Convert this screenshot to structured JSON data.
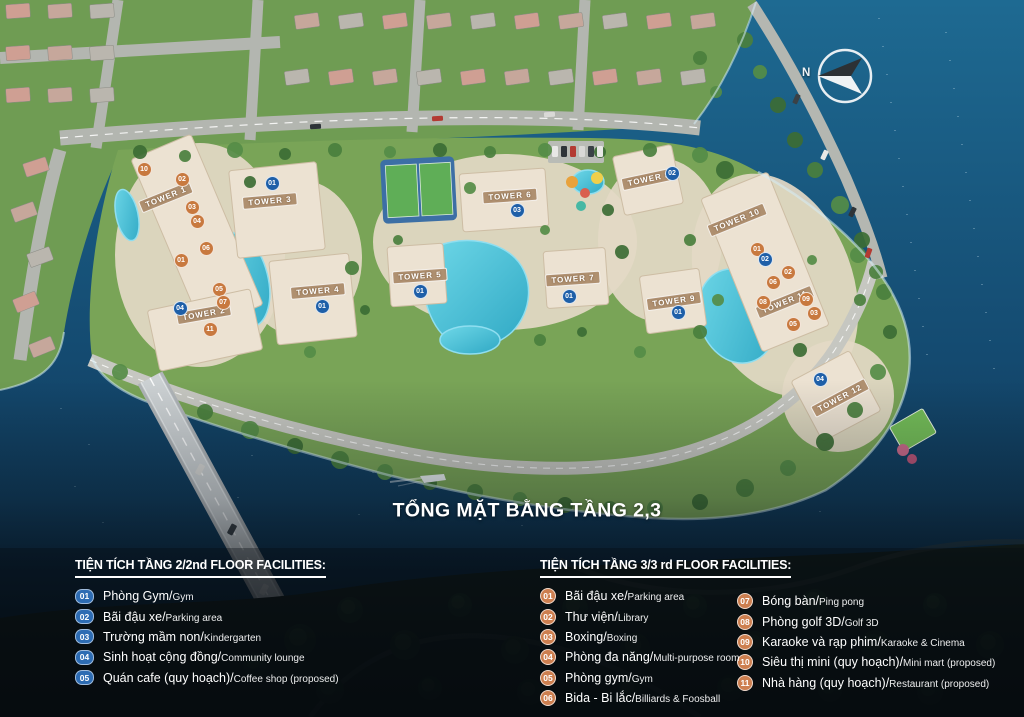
{
  "title": "TỔNG MẶT BẰNG TẦNG 2,3",
  "compass": {
    "label": "N"
  },
  "colors": {
    "badge_blue": "#2d6cb3",
    "badge_orange": "#cd7f50",
    "water": "#155a82",
    "site_ground": "#e7ddcc"
  },
  "legend_floor2": {
    "header": "TIỆN TÍCH TẦNG 2/2nd FLOOR FACILITIES:",
    "items": [
      {
        "num": "01",
        "vn": "Phòng Gym/",
        "en": "Gym"
      },
      {
        "num": "02",
        "vn": "Bãi đậu xe/",
        "en": "Parking area"
      },
      {
        "num": "03",
        "vn": "Trường mầm non/",
        "en": "Kindergarten"
      },
      {
        "num": "04",
        "vn": "Sinh hoạt cộng đồng/",
        "en": "Community lounge"
      },
      {
        "num": "05",
        "vn": "Quán cafe (quy hoạch)/",
        "en": "Coffee shop (proposed)"
      }
    ]
  },
  "legend_floor3": {
    "header": "TIỆN TÍCH TẦNG 3/3 rd FLOOR FACILITIES:",
    "items_col1": [
      {
        "num": "01",
        "vn": "Bãi đậu xe/",
        "en": "Parking area"
      },
      {
        "num": "02",
        "vn": "Thư viện/",
        "en": "Library"
      },
      {
        "num": "03",
        "vn": "Boxing/",
        "en": "Boxing"
      },
      {
        "num": "04",
        "vn": "Phòng đa năng/",
        "en": "Multi-purpose room"
      },
      {
        "num": "05",
        "vn": "Phòng gym/",
        "en": "Gym"
      },
      {
        "num": "06",
        "vn": "Bida - Bi lắc/",
        "en": "Billiards & Foosball"
      }
    ],
    "items_col2": [
      {
        "num": "07",
        "vn": "Bóng bàn/",
        "en": "Ping pong"
      },
      {
        "num": "08",
        "vn": "Phòng golf 3D/",
        "en": "Golf 3D"
      },
      {
        "num": "09",
        "vn": "Karaoke và rạp phim/",
        "en": "Karaoke & Cinema"
      },
      {
        "num": "10",
        "vn": "Siêu thị mini (quy hoạch)/",
        "en": "Mini mart (proposed)"
      },
      {
        "num": "11",
        "vn": "Nhà hàng (quy hoạch)/",
        "en": "Restaurant (proposed)"
      }
    ]
  },
  "map": {
    "towers": [
      {
        "label": "TOWER 1",
        "x": 166,
        "y": 197,
        "rot": -22
      },
      {
        "label": "TOWER 2",
        "x": 204,
        "y": 314,
        "rot": -10
      },
      {
        "label": "TOWER 3",
        "x": 270,
        "y": 201,
        "rot": -5
      },
      {
        "label": "TOWER 4",
        "x": 318,
        "y": 291,
        "rot": -5
      },
      {
        "label": "TOWER 5",
        "x": 420,
        "y": 276,
        "rot": -4
      },
      {
        "label": "TOWER 6",
        "x": 510,
        "y": 196,
        "rot": -4
      },
      {
        "label": "TOWER 7",
        "x": 573,
        "y": 279,
        "rot": -4
      },
      {
        "label": "TOWER 8",
        "x": 649,
        "y": 179,
        "rot": -12
      },
      {
        "label": "TOWER 9",
        "x": 674,
        "y": 301,
        "rot": -8
      },
      {
        "label": "TOWER 10",
        "x": 737,
        "y": 220,
        "rot": -22
      },
      {
        "label": "TOWER 11",
        "x": 785,
        "y": 302,
        "rot": -22
      },
      {
        "label": "TOWER 12",
        "x": 840,
        "y": 398,
        "rot": -28
      }
    ],
    "markers": [
      {
        "num": "10",
        "type": "f3",
        "x": 143,
        "y": 168
      },
      {
        "num": "02",
        "type": "f3",
        "x": 181,
        "y": 178
      },
      {
        "num": "03",
        "type": "f3",
        "x": 191,
        "y": 206
      },
      {
        "num": "04",
        "type": "f3",
        "x": 196,
        "y": 220
      },
      {
        "num": "06",
        "type": "f3",
        "x": 205,
        "y": 247
      },
      {
        "num": "01",
        "type": "f3",
        "x": 180,
        "y": 259
      },
      {
        "num": "05",
        "type": "f3",
        "x": 218,
        "y": 288
      },
      {
        "num": "07",
        "type": "f3",
        "x": 222,
        "y": 301
      },
      {
        "num": "11",
        "type": "f3",
        "x": 209,
        "y": 328
      },
      {
        "num": "04",
        "type": "f2",
        "x": 179,
        "y": 307
      },
      {
        "num": "01",
        "type": "f2",
        "x": 271,
        "y": 182
      },
      {
        "num": "01",
        "type": "f2",
        "x": 321,
        "y": 305
      },
      {
        "num": "01",
        "type": "f2",
        "x": 419,
        "y": 290
      },
      {
        "num": "03",
        "type": "f2",
        "x": 516,
        "y": 209
      },
      {
        "num": "01",
        "type": "f2",
        "x": 568,
        "y": 295
      },
      {
        "num": "02",
        "type": "f2",
        "x": 671,
        "y": 172
      },
      {
        "num": "01",
        "type": "f2",
        "x": 677,
        "y": 311
      },
      {
        "num": "01",
        "type": "f3",
        "x": 756,
        "y": 248
      },
      {
        "num": "02",
        "type": "f2",
        "x": 764,
        "y": 258
      },
      {
        "num": "02",
        "type": "f3",
        "x": 787,
        "y": 271
      },
      {
        "num": "06",
        "type": "f3",
        "x": 772,
        "y": 281
      },
      {
        "num": "08",
        "type": "f3",
        "x": 762,
        "y": 301
      },
      {
        "num": "09",
        "type": "f3",
        "x": 805,
        "y": 298
      },
      {
        "num": "03",
        "type": "f3",
        "x": 813,
        "y": 312
      },
      {
        "num": "05",
        "type": "f3",
        "x": 792,
        "y": 323
      },
      {
        "num": "04",
        "type": "f2",
        "x": 819,
        "y": 378
      }
    ]
  }
}
